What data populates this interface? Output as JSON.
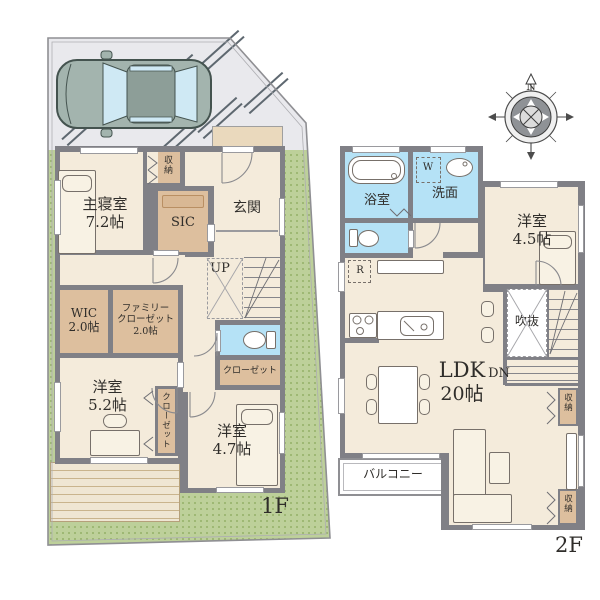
{
  "floor1": {
    "floor_label": "1F",
    "master_bedroom": {
      "name": "主寝室",
      "area": "7.2帖"
    },
    "storage_top_label": "収納",
    "sic_label": "SIC",
    "entrance_label": "玄関",
    "stairs_up_label": "UP",
    "wic": {
      "name": "WIC",
      "area": "2.0帖"
    },
    "family_closet": {
      "line1": "ファミリー",
      "line2": "クローゼット",
      "line3": "2.0帖"
    },
    "closet_mid_label": "クローゼット",
    "bedroom_52": {
      "name": "洋室",
      "area": "5.2帖"
    },
    "closet_side_label": "クローゼット",
    "bedroom_47": {
      "name": "洋室",
      "area": "4.7帖"
    }
  },
  "floor2": {
    "floor_label": "2F",
    "bathroom_label": "浴室",
    "washroom_label": "洗面",
    "washer_mark": "W",
    "fridge_mark": "R",
    "bedroom_45": {
      "name": "洋室",
      "area": "4.5帖"
    },
    "ldk": {
      "name": "LDK",
      "area": "20帖"
    },
    "void_label": "吹抜",
    "stairs_down_label": "DN",
    "storage_mid_label": "収納",
    "storage_bottom_label": "収納",
    "balcony_label": "バルコニー"
  },
  "compass": {
    "north_label": "N"
  },
  "colors": {
    "room_floor": "#f4ebdb",
    "closet_tan": "#ddbf9e",
    "wet_area_blue": "#b5e2f6",
    "wall_gray": "#808086",
    "site_green": "#bdd09a",
    "parking_gray": "#e9e9ed",
    "car_body": "#a3b4ae",
    "car_glass": "#cfe9f4"
  }
}
